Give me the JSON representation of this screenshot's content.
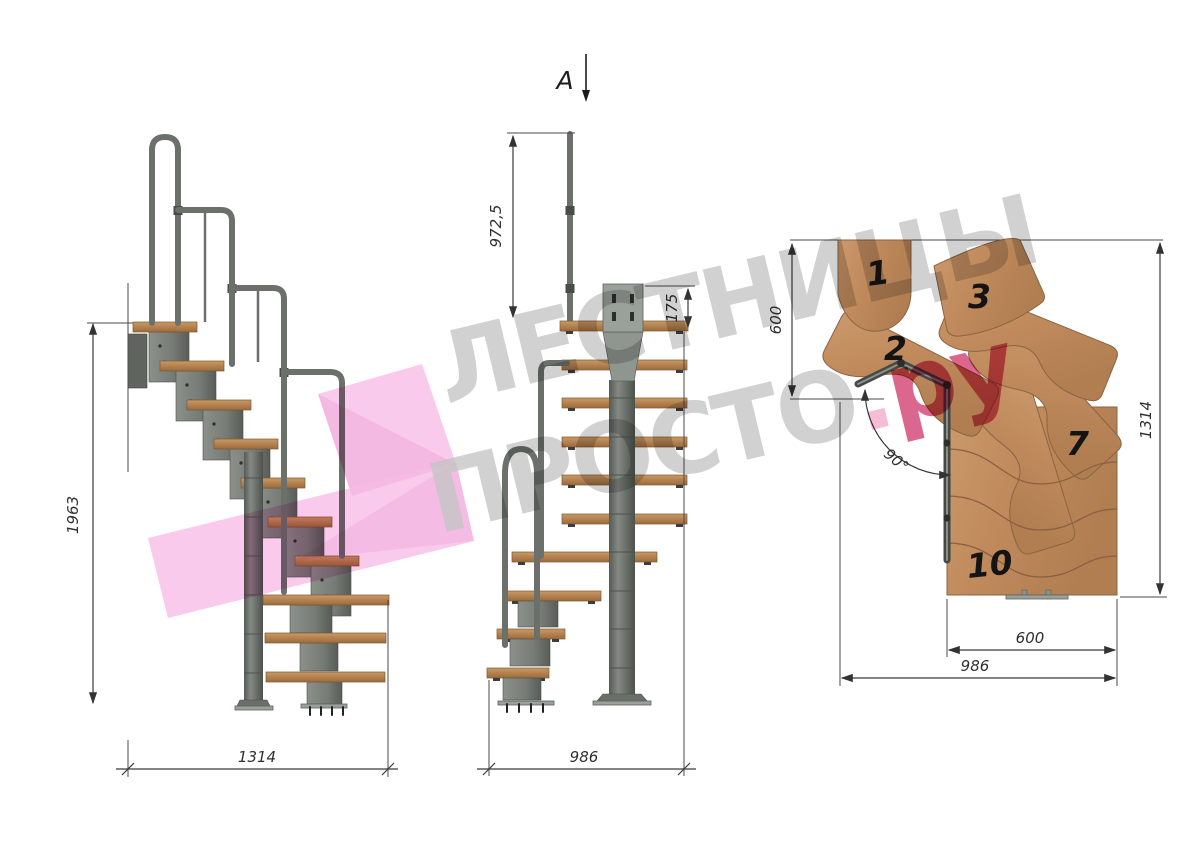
{
  "watermark": {
    "line1": "ЛЕСТНИЦЫ",
    "line2": "ПРОСТО",
    "dot": ".",
    "suffix": "ру"
  },
  "section_marker": {
    "label": "A"
  },
  "side_view": {
    "total_height": "1963",
    "total_length": "1314"
  },
  "front_view": {
    "rail_height": "972,5",
    "top_module_height": "175",
    "total_width": "986"
  },
  "plan_view": {
    "landing_depth": "600",
    "plan_length": "1314",
    "flight_width": "600",
    "plan_width": "986",
    "turn_angle": "90°",
    "steps": {
      "s1": "1",
      "s2": "2",
      "s3": "3",
      "s7": "7",
      "s10": "10"
    }
  },
  "colors": {
    "wood": "#c0895e",
    "metal": "#6e736e",
    "rail_gray": "#6b706b",
    "dimension": "#333333",
    "watermark_gray": "#c4c4c4",
    "watermark_pink": "#f7bde6",
    "accent_crimson": "#d13b6f",
    "background": "#ffffff"
  }
}
